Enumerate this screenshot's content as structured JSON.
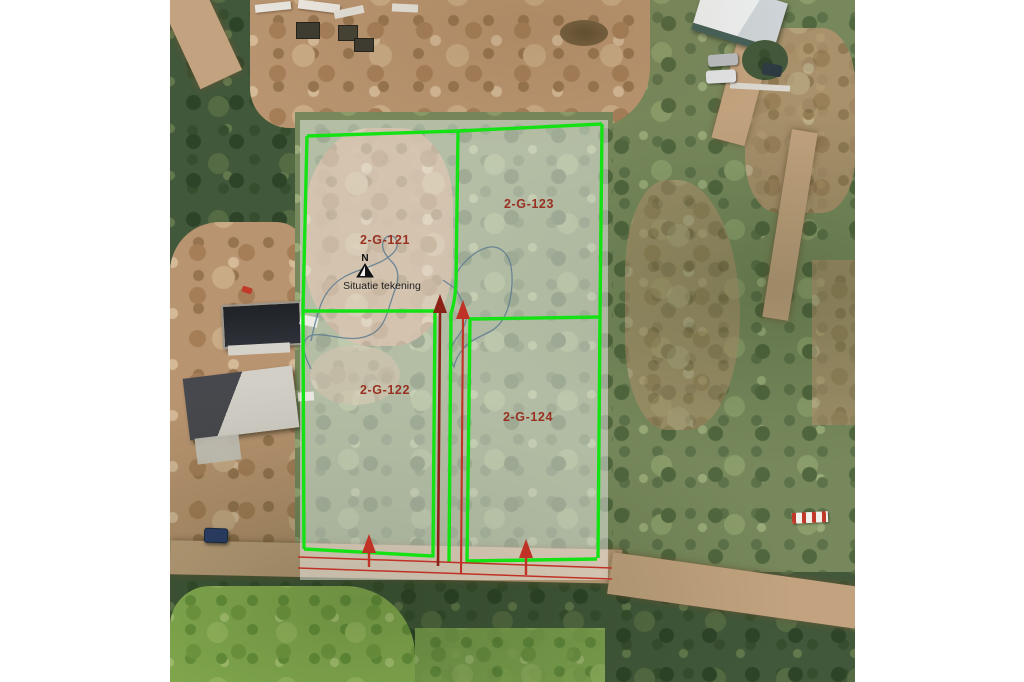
{
  "map": {
    "caption": "Situatie tekening",
    "north_label": "N",
    "parcels": [
      {
        "label": "2-G-121"
      },
      {
        "label": "2-G-122"
      },
      {
        "label": "2-G-123"
      },
      {
        "label": "2-G-124"
      }
    ],
    "colors": {
      "boundary_green": "#15e215",
      "survey_red": "#c03226",
      "survey_red_dark": "#8a2218",
      "label_red": "#993122",
      "stream_blue": "#5d7b92",
      "overlay_white": "#ffffff"
    }
  }
}
